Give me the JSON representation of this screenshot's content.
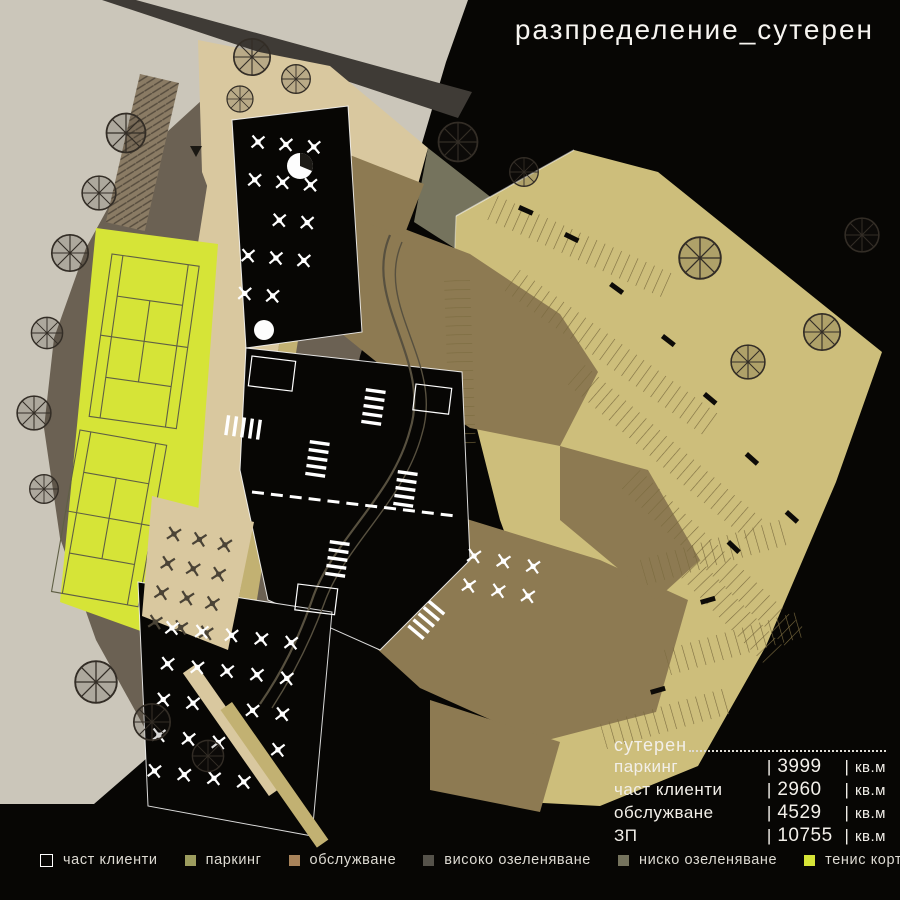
{
  "title": "разпределение_сутерен",
  "legend": {
    "items": [
      {
        "label": "част клиенти",
        "color": "transparent",
        "outline": true
      },
      {
        "label": "паркинг",
        "color": "#9c9c5e"
      },
      {
        "label": "обслужване",
        "color": "#a8835a"
      },
      {
        "label": "високо озеленяване",
        "color": "#55524a"
      },
      {
        "label": "ниско озеленяване",
        "color": "#75735d"
      },
      {
        "label": "тенис корт",
        "color": "#d6e437"
      },
      {
        "label": "плочник",
        "color": "#bfae6f"
      }
    ]
  },
  "stats": {
    "header": "сутерен",
    "separator": "|",
    "unit": "кв.м",
    "rows": [
      {
        "label": "паркинг",
        "value": "3999"
      },
      {
        "label": "част клиенти",
        "value": "2960"
      },
      {
        "label": "обслужване",
        "value": "4529"
      },
      {
        "label": "ЗП",
        "value": "10755"
      }
    ]
  },
  "palette": {
    "bg": "#070604",
    "outside": "#cbc6ba",
    "road": "#3f3b36",
    "high-green": "#6b6153",
    "low-green": "#75735d",
    "plaza": "#d9c89f",
    "plochnik": "#c2b172",
    "parking": "#cdbe7b",
    "service": "#8d7a52",
    "tennis": "#d6e437",
    "court-line": "#5f5f45",
    "stall-line": "#7a6a3e",
    "path-line": "#57503f"
  }
}
